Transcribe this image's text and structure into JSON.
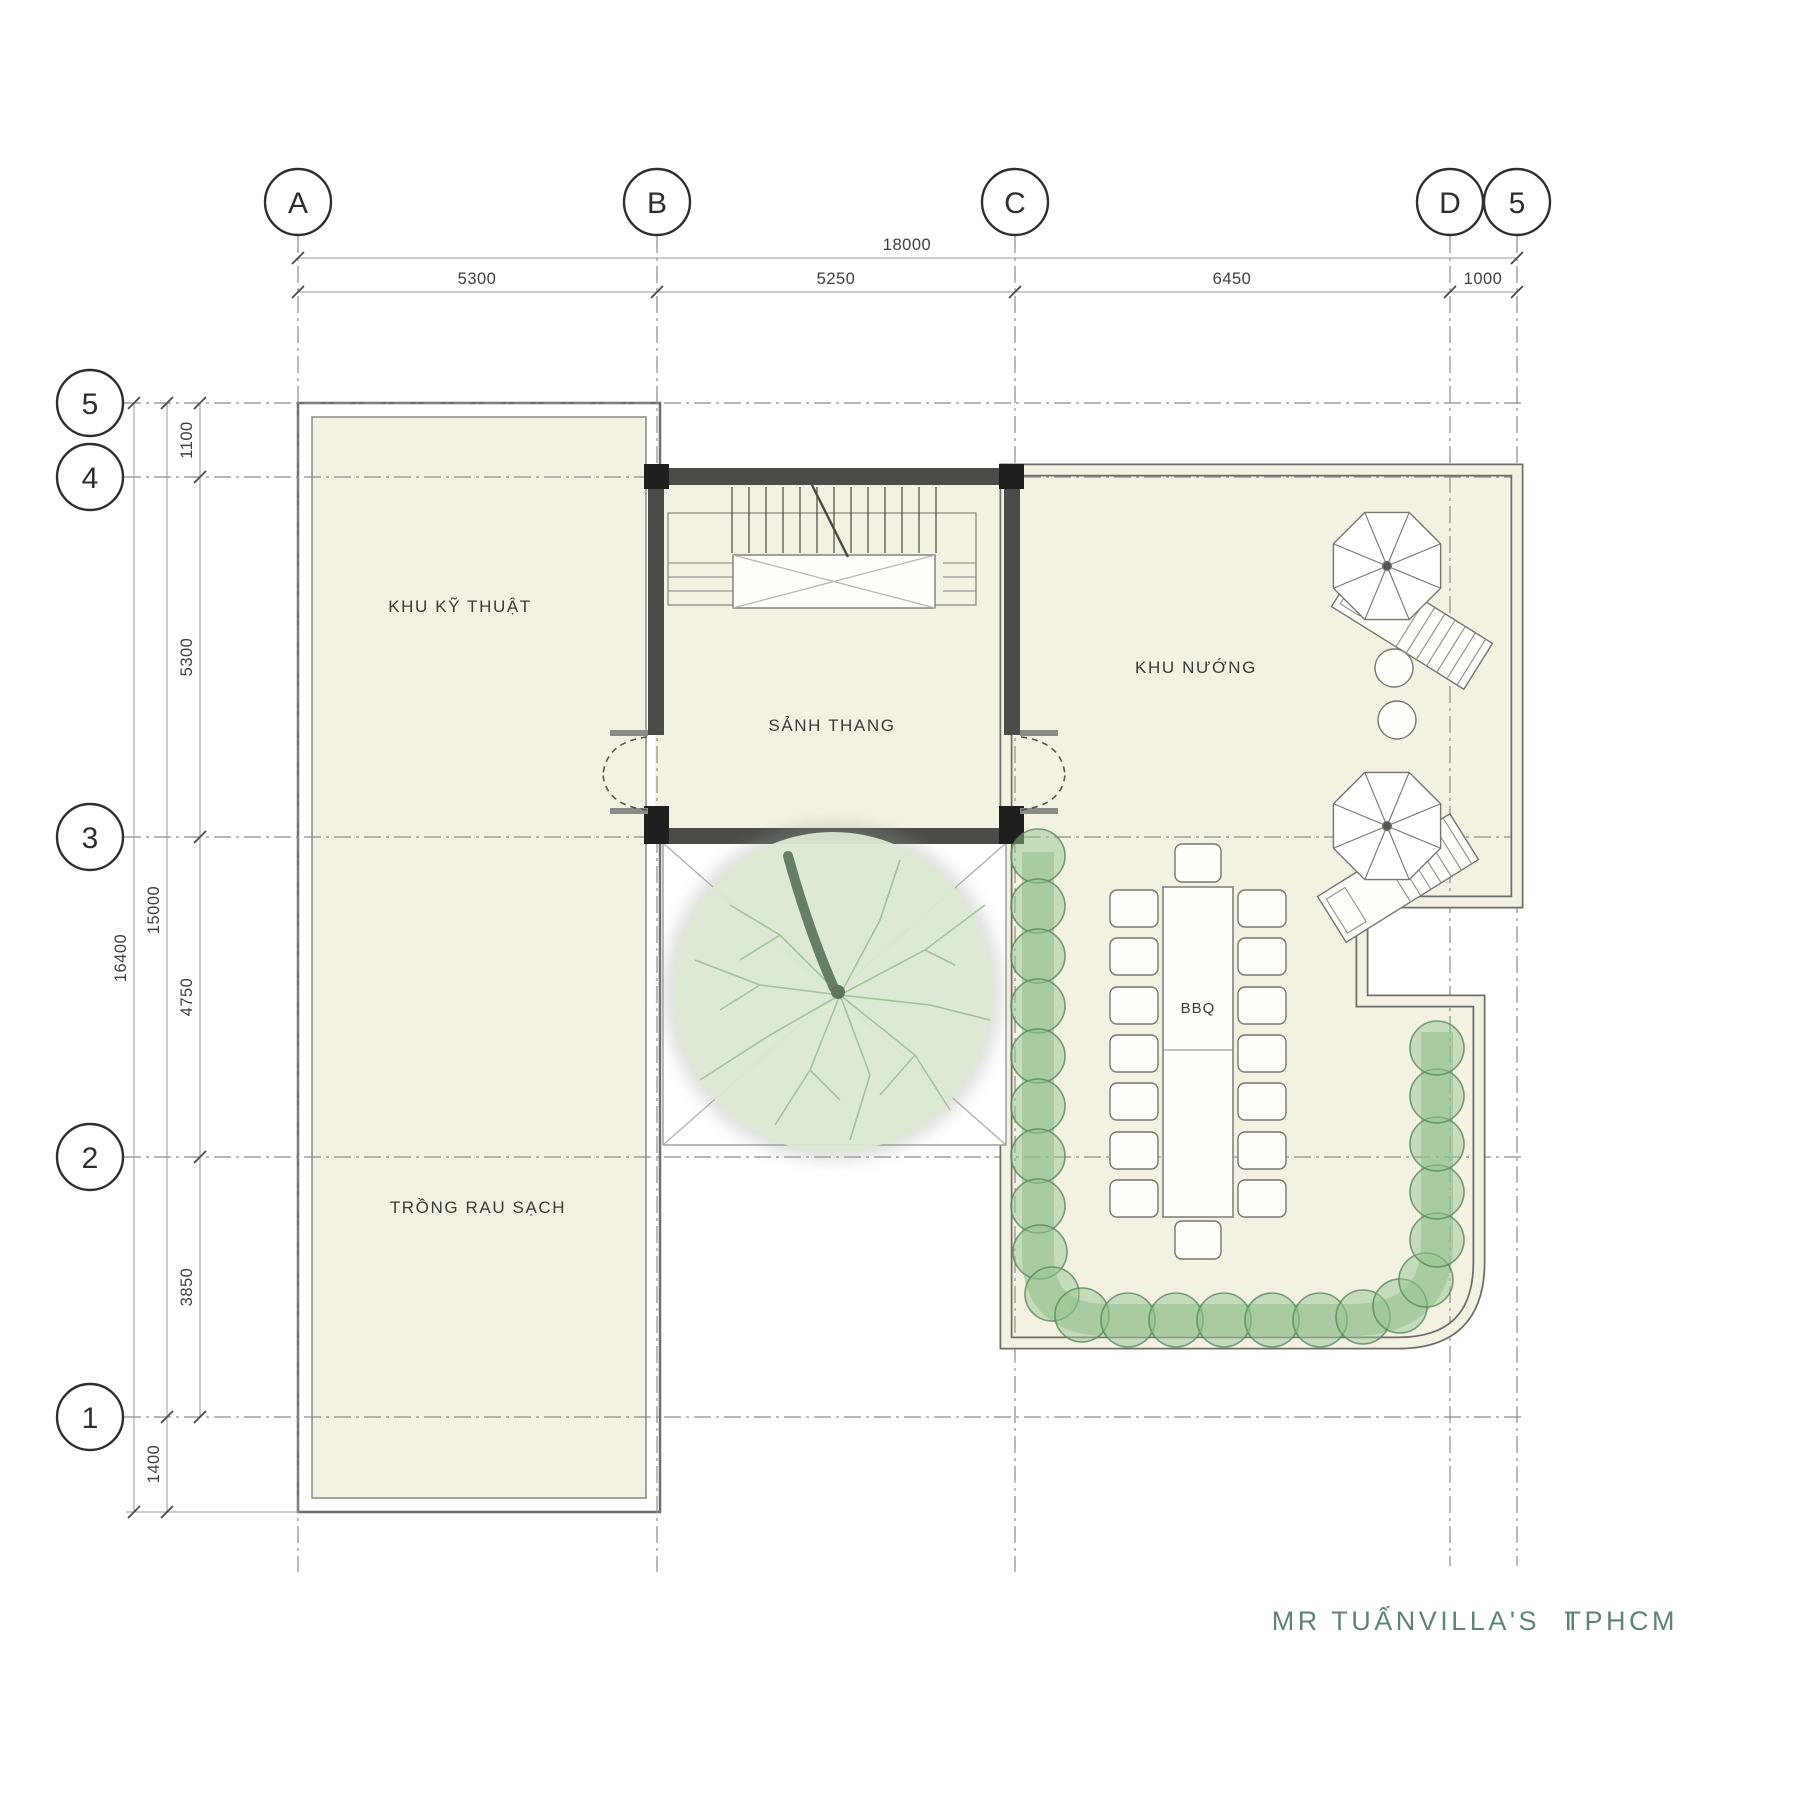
{
  "title": {
    "client": "MR TUẤNVILLA'S",
    "separator": "I",
    "location": "TPHCM",
    "color": "#5d8672"
  },
  "grid": {
    "cols": [
      {
        "label": "A"
      },
      {
        "label": "B"
      },
      {
        "label": "C"
      },
      {
        "label": "D"
      },
      {
        "label": "5"
      }
    ],
    "rows": [
      {
        "label": "5"
      },
      {
        "label": "4"
      },
      {
        "label": "3"
      },
      {
        "label": "2"
      },
      {
        "label": "1"
      }
    ]
  },
  "dimensions": {
    "top": {
      "total": "18000",
      "segments": [
        "5300",
        "5250",
        "6450",
        "1000"
      ]
    },
    "left": {
      "overall": "16400",
      "main": "15000",
      "below": "1400",
      "segments": [
        "1100",
        "5300",
        "4750",
        "3850"
      ]
    }
  },
  "rooms": {
    "technical": {
      "label": "KHU KỸ THUẬT"
    },
    "stair_hall": {
      "label": "SẢNH THANG"
    },
    "grill": {
      "label": "KHU NƯỚNG"
    },
    "vegetable": {
      "label": "TRỒNG RAU SẠCH"
    },
    "bbq": {
      "label": "BBQ"
    }
  },
  "colors": {
    "room_fill": "#f3f1e2",
    "wall": "#6e6e6b",
    "dark_wall": "#4b4b48",
    "hedge_green": "#97c592",
    "tree_green": "#dbead3",
    "title_green": "#5d8672"
  }
}
